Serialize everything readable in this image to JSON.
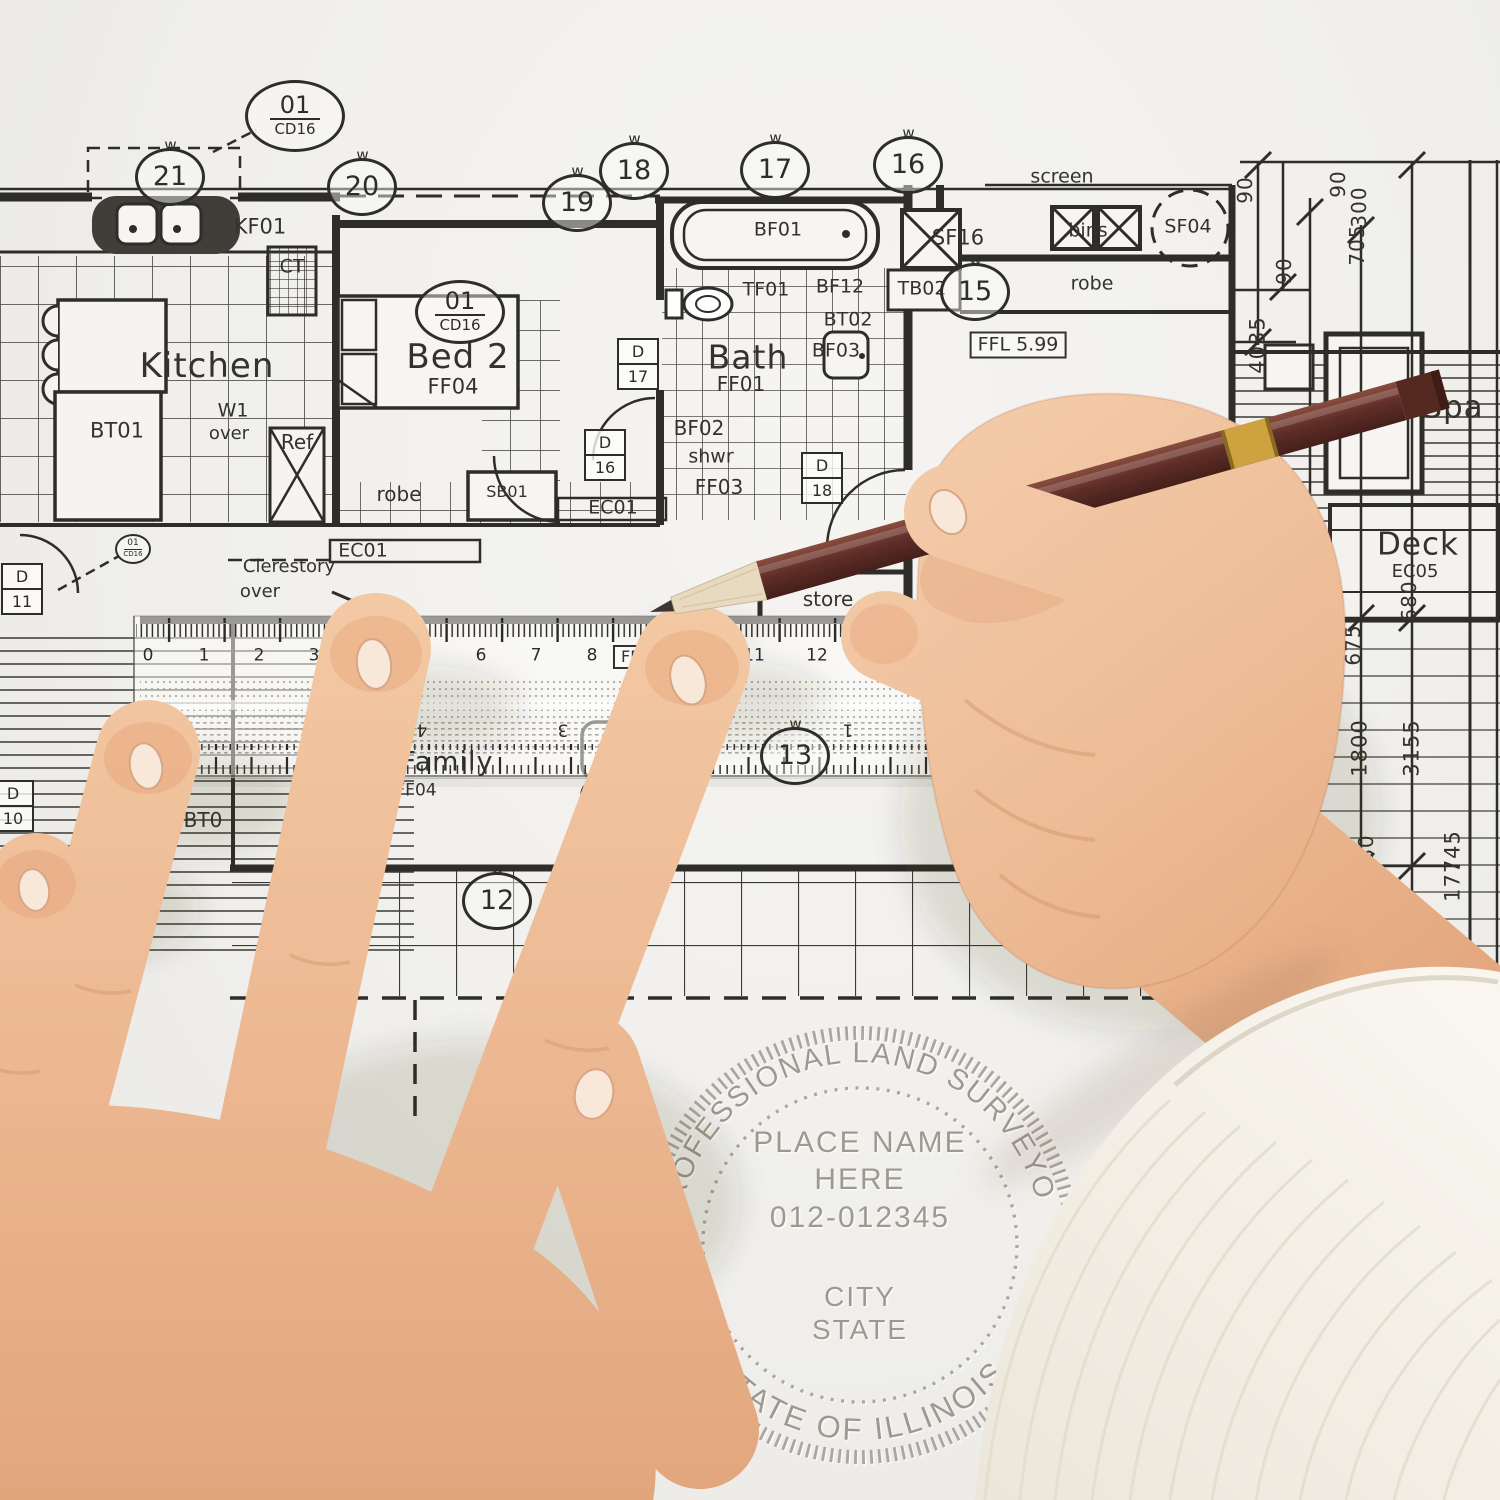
{
  "plan": {
    "labels": [
      {
        "id": "kf01",
        "text": "KF01",
        "x": 260,
        "y": 227,
        "fs": 21
      },
      {
        "id": "ct",
        "text": "CT",
        "x": 292,
        "y": 267,
        "fs": 19
      },
      {
        "id": "kitchen",
        "text": "Kitchen",
        "x": 207,
        "y": 366,
        "fs": 34,
        "cls": "big"
      },
      {
        "id": "bt01",
        "text": "BT01",
        "x": 117,
        "y": 431,
        "fs": 21
      },
      {
        "id": "w1",
        "text": "W1",
        "x": 233,
        "y": 411,
        "fs": 19
      },
      {
        "id": "w1-over",
        "text": "over",
        "x": 229,
        "y": 434,
        "fs": 18
      },
      {
        "id": "ref",
        "text": "Ref",
        "x": 297,
        "y": 442,
        "fs": 20
      },
      {
        "id": "robe-1",
        "text": "robe",
        "x": 399,
        "y": 494,
        "fs": 20
      },
      {
        "id": "sb01",
        "text": "SB01",
        "x": 507,
        "y": 492,
        "fs": 16
      },
      {
        "id": "ec01-a",
        "text": "EC01",
        "x": 363,
        "y": 551,
        "fs": 19
      },
      {
        "id": "clerestory",
        "text": "Clerestory",
        "x": 289,
        "y": 567,
        "fs": 18
      },
      {
        "id": "clerestory-over",
        "text": "over",
        "x": 260,
        "y": 592,
        "fs": 18
      },
      {
        "id": "ec01-b",
        "text": "EC01",
        "x": 613,
        "y": 508,
        "fs": 19
      },
      {
        "id": "bed2",
        "text": "Bed 2",
        "x": 458,
        "y": 357,
        "fs": 34,
        "cls": "big"
      },
      {
        "id": "ff04",
        "text": "FF04",
        "x": 453,
        "y": 387,
        "fs": 21
      },
      {
        "id": "bath",
        "text": "Bath",
        "x": 748,
        "y": 357,
        "fs": 33,
        "cls": "big"
      },
      {
        "id": "ff01",
        "text": "FF01",
        "x": 741,
        "y": 384,
        "fs": 20
      },
      {
        "id": "tf01",
        "text": "TF01",
        "x": 766,
        "y": 290,
        "fs": 19
      },
      {
        "id": "bf01",
        "text": "BF01",
        "x": 778,
        "y": 230,
        "fs": 19
      },
      {
        "id": "bf12",
        "text": "BF12",
        "x": 840,
        "y": 287,
        "fs": 19
      },
      {
        "id": "bt02",
        "text": "BT02",
        "x": 848,
        "y": 320,
        "fs": 19
      },
      {
        "id": "bf03",
        "text": "BF03",
        "x": 836,
        "y": 351,
        "fs": 19
      },
      {
        "id": "bf02",
        "text": "BF02",
        "x": 699,
        "y": 428,
        "fs": 20
      },
      {
        "id": "shwr",
        "text": "shwr",
        "x": 711,
        "y": 457,
        "fs": 19
      },
      {
        "id": "ff03",
        "text": "FF03",
        "x": 719,
        "y": 487,
        "fs": 20
      },
      {
        "id": "sf16",
        "text": "SF16",
        "x": 958,
        "y": 238,
        "fs": 21
      },
      {
        "id": "screen",
        "text": "screen",
        "x": 1062,
        "y": 177,
        "fs": 19
      },
      {
        "id": "bins",
        "text": "bins",
        "x": 1088,
        "y": 231,
        "fs": 19
      },
      {
        "id": "sf04",
        "text": "SF04",
        "x": 1188,
        "y": 227,
        "fs": 19
      },
      {
        "id": "tb02",
        "text": "TB02",
        "x": 922,
        "y": 289,
        "fs": 19
      },
      {
        "id": "robe-2",
        "text": "robe",
        "x": 1092,
        "y": 284,
        "fs": 19
      },
      {
        "id": "ffl-right",
        "text": "FFL 5.99",
        "x": 1018,
        "y": 345,
        "fs": 19,
        "cls": "boxed"
      },
      {
        "id": "ffl-ruler",
        "text": "FFL 5.99",
        "x": 655,
        "y": 657,
        "fs": 16,
        "cls": "boxed"
      },
      {
        "id": "store",
        "text": "store",
        "x": 828,
        "y": 599,
        "fs": 20
      },
      {
        "id": "bt0",
        "text": "BT0",
        "x": 203,
        "y": 820,
        "fs": 20
      },
      {
        "id": "family",
        "text": "Family",
        "x": 447,
        "y": 762,
        "fs": 27,
        "cls": "big"
      },
      {
        "id": "family-code",
        "text": "FF04",
        "x": 416,
        "y": 791,
        "fs": 17
      },
      {
        "id": "p-room",
        "text": "P",
        "x": 953,
        "y": 822,
        "fs": 28
      },
      {
        "id": "spa",
        "text": "Spa",
        "x": 1453,
        "y": 408,
        "fs": 31,
        "cls": "big"
      },
      {
        "id": "deck",
        "text": "Deck",
        "x": 1418,
        "y": 545,
        "fs": 31,
        "cls": "big"
      },
      {
        "id": "ec05",
        "text": "EC05",
        "x": 1415,
        "y": 572,
        "fs": 18
      },
      {
        "id": "dim-90-a",
        "text": "90",
        "x": 1245,
        "y": 190,
        "fs": 20,
        "rot": -90,
        "cls": "dim"
      },
      {
        "id": "dim-90-b",
        "text": "90",
        "x": 1338,
        "y": 184,
        "fs": 20,
        "rot": -90,
        "cls": "dim"
      },
      {
        "id": "dim-300",
        "text": "300",
        "x": 1359,
        "y": 207,
        "fs": 20,
        "rot": -90,
        "cls": "dim"
      },
      {
        "id": "dim-705",
        "text": "705",
        "x": 1357,
        "y": 245,
        "fs": 20,
        "rot": -90,
        "cls": "dim"
      },
      {
        "id": "dim-90-c",
        "text": "90",
        "x": 1284,
        "y": 271,
        "fs": 20,
        "rot": -90,
        "cls": "dim"
      },
      {
        "id": "dim-4035",
        "text": "4035",
        "x": 1258,
        "y": 345,
        "fs": 21,
        "rot": -90,
        "cls": "dim"
      },
      {
        "id": "dim-675",
        "text": "675",
        "x": 1353,
        "y": 645,
        "fs": 20,
        "rot": -90,
        "cls": "dim"
      },
      {
        "id": "dim-680-a",
        "text": "680",
        "x": 1409,
        "y": 601,
        "fs": 20,
        "rot": -90,
        "cls": "dim"
      },
      {
        "id": "dim-1800",
        "text": "1800",
        "x": 1360,
        "y": 748,
        "fs": 21,
        "rot": -90,
        "cls": "dim"
      },
      {
        "id": "dim-3155",
        "text": "3155",
        "x": 1412,
        "y": 748,
        "fs": 21,
        "rot": -90,
        "cls": "dim"
      },
      {
        "id": "dim-680-b",
        "text": "680",
        "x": 1366,
        "y": 855,
        "fs": 20,
        "rot": -90,
        "cls": "dim"
      },
      {
        "id": "dim-45",
        "text": "45",
        "x": 1341,
        "y": 871,
        "fs": 20,
        "rot": -90,
        "cls": "dim"
      },
      {
        "id": "dim-17745",
        "text": "17745",
        "x": 1453,
        "y": 866,
        "fs": 21,
        "rot": -90,
        "cls": "dim"
      },
      {
        "id": "dim-1500",
        "text": "1500",
        "x": 1362,
        "y": 936,
        "fs": 21,
        "rot": -90,
        "cls": "dim"
      },
      {
        "id": "dim-5795",
        "text": "5795",
        "x": 1411,
        "y": 1100,
        "fs": 21,
        "rot": -90,
        "cls": "dim"
      },
      {
        "id": "ruler-0",
        "text": "0",
        "x": 148,
        "y": 656,
        "fs": 17,
        "cls": "rnum"
      },
      {
        "id": "ruler-1",
        "text": "1",
        "x": 204,
        "y": 656,
        "fs": 17,
        "cls": "rnum"
      },
      {
        "id": "ruler-2",
        "text": "2",
        "x": 259,
        "y": 656,
        "fs": 17,
        "cls": "rnum"
      },
      {
        "id": "ruler-3",
        "text": "3",
        "x": 314,
        "y": 656,
        "fs": 17,
        "cls": "rnum"
      },
      {
        "id": "ruler-4",
        "text": "4",
        "x": 371,
        "y": 656,
        "fs": 17,
        "cls": "rnum"
      },
      {
        "id": "ruler-5",
        "text": "5",
        "x": 426,
        "y": 656,
        "fs": 17,
        "cls": "rnum"
      },
      {
        "id": "ruler-6",
        "text": "6",
        "x": 481,
        "y": 656,
        "fs": 17,
        "cls": "rnum"
      },
      {
        "id": "ruler-7",
        "text": "7",
        "x": 536,
        "y": 656,
        "fs": 17,
        "cls": "rnum"
      },
      {
        "id": "ruler-8",
        "text": "8",
        "x": 592,
        "y": 656,
        "fs": 17,
        "cls": "rnum"
      },
      {
        "id": "ruler-9",
        "text": "9",
        "x": 646,
        "y": 648,
        "fs": 17,
        "cls": "rnum"
      },
      {
        "id": "ruler-10",
        "text": "10",
        "x": 705,
        "y": 656,
        "fs": 17,
        "cls": "rnum"
      },
      {
        "id": "ruler-11",
        "text": "11",
        "x": 754,
        "y": 656,
        "fs": 17,
        "cls": "rnum"
      },
      {
        "id": "ruler-12",
        "text": "12",
        "x": 817,
        "y": 656,
        "fs": 17,
        "cls": "rnum"
      },
      {
        "id": "ruler-b4",
        "text": "4",
        "x": 422,
        "y": 729,
        "fs": 17,
        "rot": 180,
        "cls": "rnum"
      },
      {
        "id": "ruler-b3",
        "text": "3",
        "x": 563,
        "y": 729,
        "fs": 17,
        "rot": 180,
        "cls": "rnum"
      },
      {
        "id": "ruler-b2",
        "text": "2",
        "x": 705,
        "y": 730,
        "fs": 17,
        "rot": 180,
        "cls": "rnum"
      },
      {
        "id": "ruler-b1",
        "text": "1",
        "x": 848,
        "y": 729,
        "fs": 17,
        "rot": 180,
        "cls": "rnum"
      }
    ],
    "callouts": [
      {
        "n": "01",
        "sub": "CD16",
        "x": 295,
        "y": 116,
        "w": 94,
        "h": 66
      },
      {
        "n": "01",
        "sub": "CD16",
        "x": 460,
        "y": 312,
        "w": 84,
        "h": 58
      },
      {
        "n": "01",
        "sub": "CD16",
        "x": 133,
        "y": 549,
        "w": 32,
        "h": 26,
        "tiny": true
      },
      {
        "n": "21",
        "x": 170,
        "y": 177,
        "w": 64,
        "h": 52
      },
      {
        "n": "20",
        "x": 362,
        "y": 187,
        "w": 64,
        "h": 52
      },
      {
        "n": "19",
        "x": 577,
        "y": 203,
        "w": 64,
        "h": 52
      },
      {
        "n": "18",
        "x": 634,
        "y": 171,
        "w": 64,
        "h": 52
      },
      {
        "n": "17",
        "x": 775,
        "y": 170,
        "w": 64,
        "h": 52
      },
      {
        "n": "16",
        "x": 908,
        "y": 165,
        "w": 64,
        "h": 52
      },
      {
        "n": "15",
        "x": 975,
        "y": 292,
        "w": 64,
        "h": 52
      },
      {
        "n": "12",
        "x": 497,
        "y": 901,
        "w": 64,
        "h": 52
      },
      {
        "n": "13",
        "x": 795,
        "y": 756,
        "w": 64,
        "h": 52
      },
      {
        "n": "14",
        "x": 1062,
        "y": 618,
        "w": 64,
        "h": 52
      }
    ],
    "door_tags": [
      {
        "letter": "D",
        "n": "17",
        "x": 638,
        "y": 364
      },
      {
        "letter": "D",
        "n": "16",
        "x": 605,
        "y": 455
      },
      {
        "letter": "D",
        "n": "18",
        "x": 822,
        "y": 478
      },
      {
        "letter": "D",
        "n": "11",
        "x": 22,
        "y": 589
      },
      {
        "letter": "D",
        "n": "10",
        "x": 13,
        "y": 806
      }
    ]
  },
  "seal": {
    "top_arc": "PROFESSIONAL LAND SURVEYOR",
    "bottom_arc": "STATE OF ILLINOIS",
    "line1": "PLACE NAME",
    "line2": "HERE",
    "line3": "012-012345",
    "line4": "CITY",
    "line5": "STATE",
    "color": "#948d83"
  },
  "colors": {
    "paper": "#f1efec",
    "ink": "#2f2d29",
    "skin": "#ecb892",
    "pencil_body": "#5f2f28",
    "pencil_band": "#cda23f",
    "sleeve": "#f4f1e9",
    "ruler_tint": "rgba(253,253,251,0.52)"
  }
}
